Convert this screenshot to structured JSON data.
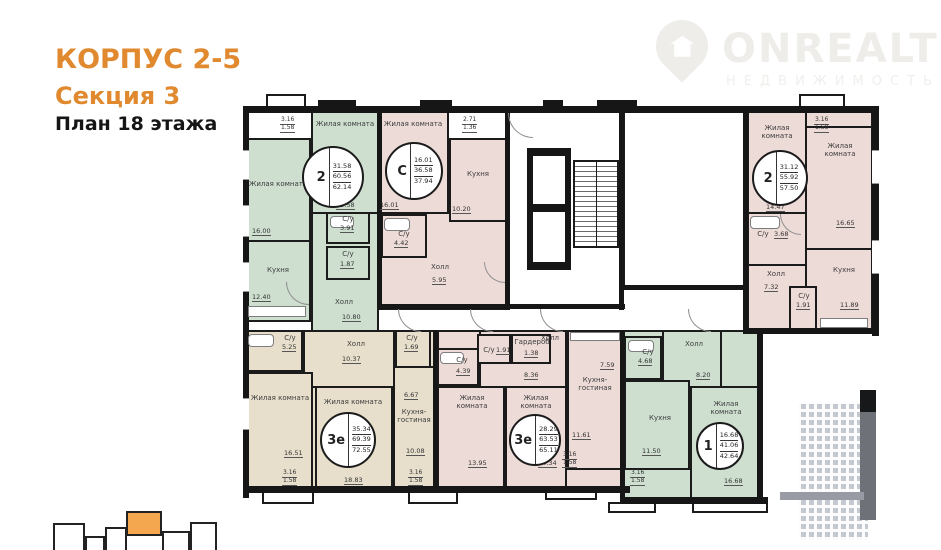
{
  "header": {
    "building": "КОРПУС 2-5",
    "section": "Секция 3",
    "floor": "План 18 этажа"
  },
  "logo": {
    "name": "ONREALT",
    "subtitle": "НЕДВИЖИМОСТЬ"
  },
  "colors": {
    "accent_orange": "#e0892f",
    "keyplan_orange": "#f4a74e",
    "room_green": "#cedfd0",
    "room_pink": "#eddbd7",
    "room_beige": "#e7dfcb",
    "wall": "#161616"
  },
  "apartments": [
    {
      "id": "apt-2-left",
      "type": "2",
      "area_living": "31.58",
      "area_mid": "60.56",
      "area_total": "62.14",
      "rooms": [
        {
          "name": "Жилая комната",
          "area": "16.00"
        },
        {
          "name": "Кухня",
          "area": "12.40"
        },
        {
          "name": "Жилая комната",
          "area": "15.58"
        },
        {
          "name": "С/у",
          "area": "3.91"
        },
        {
          "name": "С/у",
          "area": "1.87"
        },
        {
          "name": "Холл",
          "area": "10.80"
        }
      ]
    },
    {
      "id": "apt-studio-c",
      "type": "С",
      "area_living": "16.01",
      "area_mid": "36.58",
      "area_total": "37.94",
      "rooms": [
        {
          "name": "Жилая комната",
          "area": "16.01"
        },
        {
          "name": "Кухня",
          "area": "10.20"
        },
        {
          "name": "С/у",
          "area": "4.42"
        },
        {
          "name": "Холл",
          "area": "5.95"
        }
      ]
    },
    {
      "id": "apt-2-right",
      "type": "2",
      "area_living": "31.12",
      "area_mid": "55.92",
      "area_total": "57.50",
      "rooms": [
        {
          "name": "Жилая комната",
          "area": "14.47"
        },
        {
          "name": "С/у",
          "area": "3.68"
        },
        {
          "name": "Холл",
          "area": "7.32"
        },
        {
          "name": "С/у",
          "area": "1.91"
        },
        {
          "name": "Жилая комната",
          "area": "16.65"
        },
        {
          "name": "Кухня",
          "area": "11.89"
        }
      ]
    },
    {
      "id": "apt-3e-left",
      "type": "3е",
      "area_living": "35.34",
      "area_mid": "69.39",
      "area_total": "72.55",
      "rooms": [
        {
          "name": "С/у",
          "area": "5.25"
        },
        {
          "name": "Холл",
          "area": "10.37"
        },
        {
          "name": "С/у",
          "area": "1.69"
        },
        {
          "name": "Жилая комната",
          "area": "16.51"
        },
        {
          "name": "Жилая комната",
          "area": "18.83"
        },
        {
          "name": "Кухня-гостиная",
          "area": "10.08"
        },
        {
          "name": "",
          "area": "6.67"
        }
      ]
    },
    {
      "id": "apt-3e-mid",
      "type": "3е",
      "area_living": "28.29",
      "area_mid": "63.53",
      "area_total": "65.11",
      "rooms": [
        {
          "name": "С/у",
          "area": "4.39"
        },
        {
          "name": "С/у",
          "area": "1.91"
        },
        {
          "name": "Гардероб",
          "area": "1.38"
        },
        {
          "name": "Холл",
          "area": "8.36"
        },
        {
          "name": "Жилая комната",
          "area": "13.95"
        },
        {
          "name": "Жилая комната",
          "area": "14.34"
        },
        {
          "name": "Кухня-гостиная",
          "area": "11.61"
        },
        {
          "name": "",
          "area": "7.59"
        }
      ]
    },
    {
      "id": "apt-1",
      "type": "1",
      "area_living": "16.68",
      "area_mid": "41.06",
      "area_total": "42.64",
      "rooms": [
        {
          "name": "С/у",
          "area": "4.68"
        },
        {
          "name": "Холл",
          "area": "8.20"
        },
        {
          "name": "Кухня",
          "area": "11.50"
        },
        {
          "name": "Жилая комната",
          "area": "16.68"
        }
      ]
    }
  ],
  "dims": [
    {
      "a": "3.16",
      "b": "1.58"
    },
    {
      "a": "2.71",
      "b": "1.36"
    },
    {
      "a": "3.16",
      "b": "1.58"
    },
    {
      "a": "3.16",
      "b": "1.58"
    },
    {
      "a": "3.16",
      "b": "1.58"
    },
    {
      "a": "3.16",
      "b": "1.58"
    },
    {
      "a": "3.16",
      "b": "1.58"
    }
  ]
}
